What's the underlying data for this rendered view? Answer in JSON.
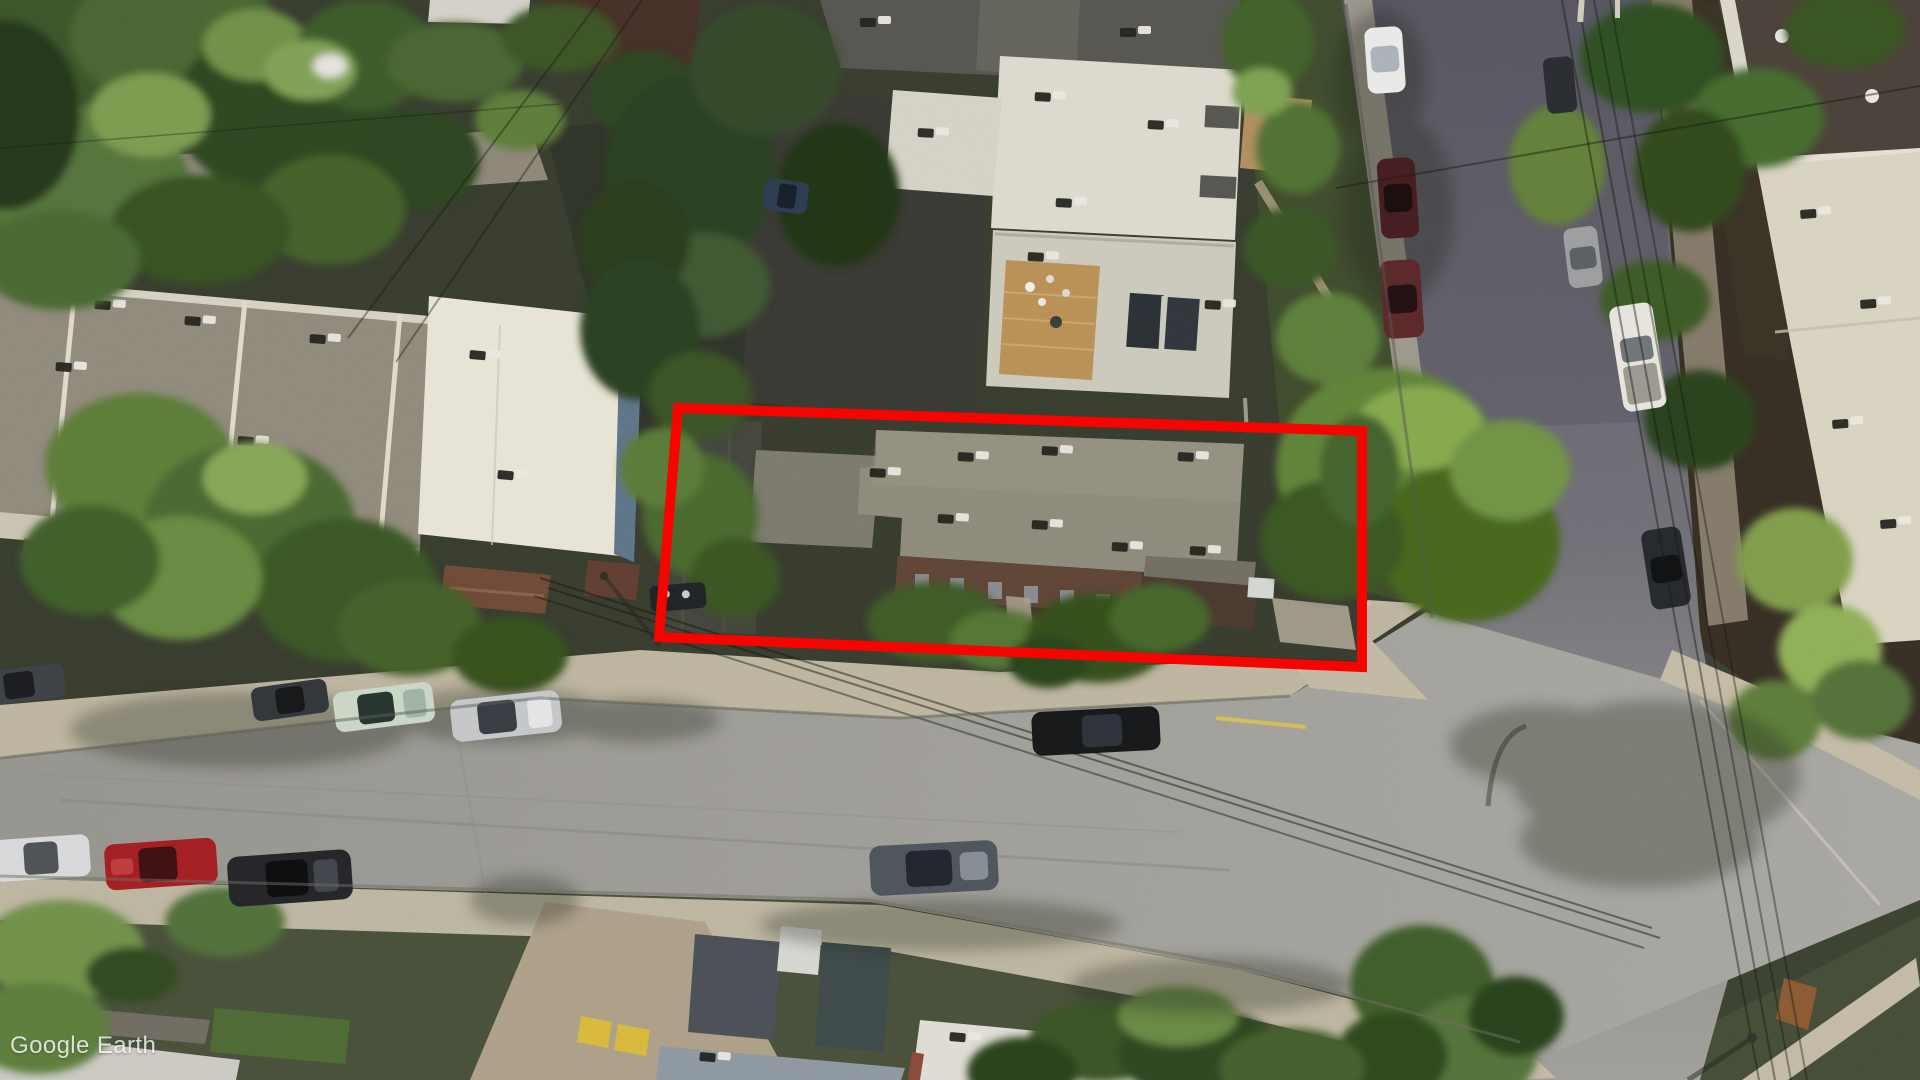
{
  "app": {
    "name": "Google Earth"
  },
  "watermark": {
    "text": "Google Earth"
  },
  "annotation": {
    "label": "highlighted property outline",
    "color": "#f50400",
    "stroke_width": 10,
    "points": "678,408 1362,431 1362,667 659,637"
  },
  "scene": {
    "type": "oblique aerial imagery of a residential block",
    "palette": {
      "street": "#a09e98",
      "cross_street_dark": "#5f5e67",
      "sidewalk": "#c3baa5",
      "roof_light": "#dcd9cd",
      "roof_taupe": "#8f897b",
      "roof_cream": "#e7e3d5",
      "roof_dark_brown": "#4a423a",
      "brick_facade": "#5e4537",
      "deck_wood": "#b98f56",
      "tree_dark": "#2f4722",
      "tree_light": "#6f8f46",
      "annotation_red": "#f50400",
      "curb_yellow": "#d9c050"
    },
    "vehicles": [
      {
        "color": "#33363b",
        "location": "north curb west, parked dark car"
      },
      {
        "color": "#c9d6c6",
        "location": "north curb west, parked pale-green car"
      },
      {
        "color": "#c4c6c7",
        "location": "north curb west, parked silver car"
      },
      {
        "color": "#d6d8d9",
        "location": "south curb west, parked white car"
      },
      {
        "color": "#a31f22",
        "location": "south curb west, parked red car"
      },
      {
        "color": "#242629",
        "location": "south curb west, parked black car"
      },
      {
        "color": "#4e545c",
        "location": "main street lane, gray sedan"
      },
      {
        "color": "#17191b",
        "location": "north curb center, black SUV"
      },
      {
        "color": "#e9e9e7",
        "location": "cross street north, white car"
      },
      {
        "color": "#451e22",
        "location": "cross street west curb, maroon car"
      },
      {
        "color": "#5a2929",
        "location": "cross street west curb, dark-red car"
      },
      {
        "color": "#e6e4dc",
        "location": "cross street east side, white pickup"
      },
      {
        "color": "#26292e",
        "location": "cross street east side, dark car"
      },
      {
        "color": "#2e3c50",
        "location": "rear lane, dark-blue car"
      }
    ]
  }
}
